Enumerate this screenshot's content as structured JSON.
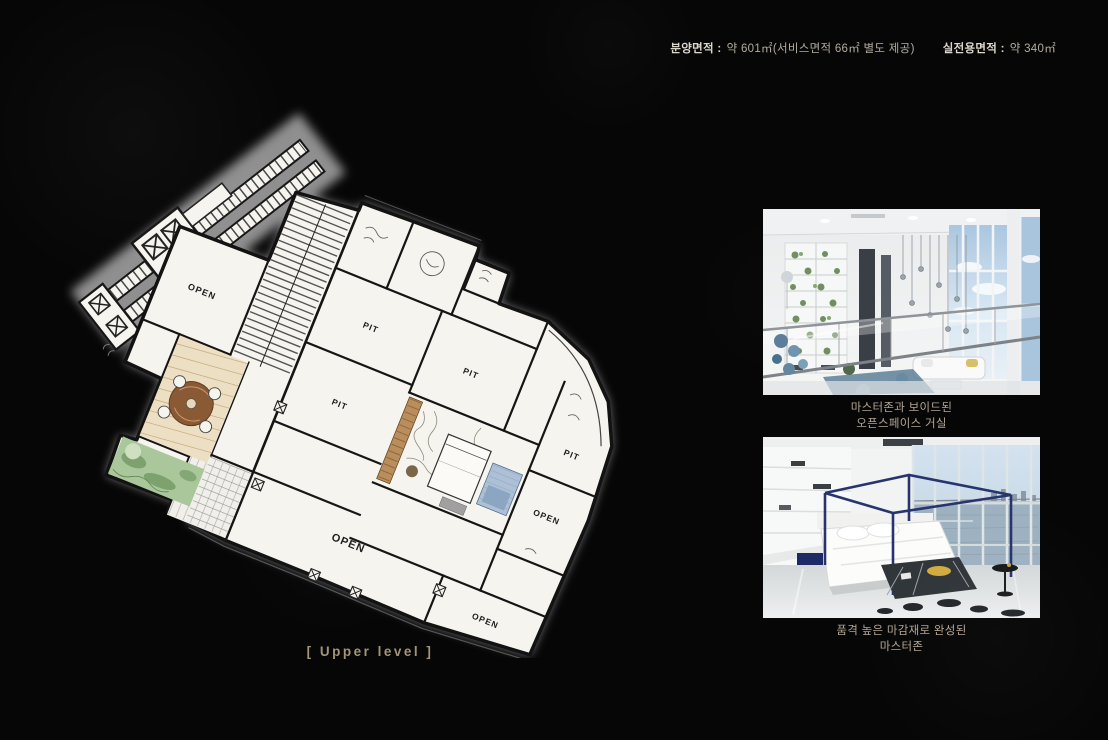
{
  "header": {
    "area1_label": "분양면적 :",
    "area1_value": "약 601㎡(서비스면적 66㎡ 별도 제공)",
    "area2_label": "실전용면적 :",
    "area2_value": "약 340㎡"
  },
  "floor_plan": {
    "level_caption": "[ Upper level ]",
    "room_labels": [
      {
        "text": "OPEN"
      },
      {
        "text": "PIT"
      },
      {
        "text": "PIT"
      },
      {
        "text": "PIT"
      },
      {
        "text": "PIT"
      },
      {
        "text": "OPEN"
      },
      {
        "text": "OPEN"
      },
      {
        "text": "OPEN"
      }
    ]
  },
  "photos": [
    {
      "caption": [
        "마스터존과 보이드된",
        "오픈스페이스 거실"
      ]
    },
    {
      "caption": [
        "품격 높은 마감재로 완성된",
        "마스터존"
      ]
    }
  ],
  "colors": {
    "background": "#060606",
    "header_label": "#dcd7cb",
    "header_value": "#b2ada1",
    "caption_text": "#b3a593",
    "level_caption_text": "#a3947a",
    "plan_paper": "#f6f4ee",
    "terrace_green": "#a9c79b",
    "wood_tan": "#b98e5c",
    "bath_blue": "#adc0d6",
    "bed_frame_navy": "#27346e"
  }
}
